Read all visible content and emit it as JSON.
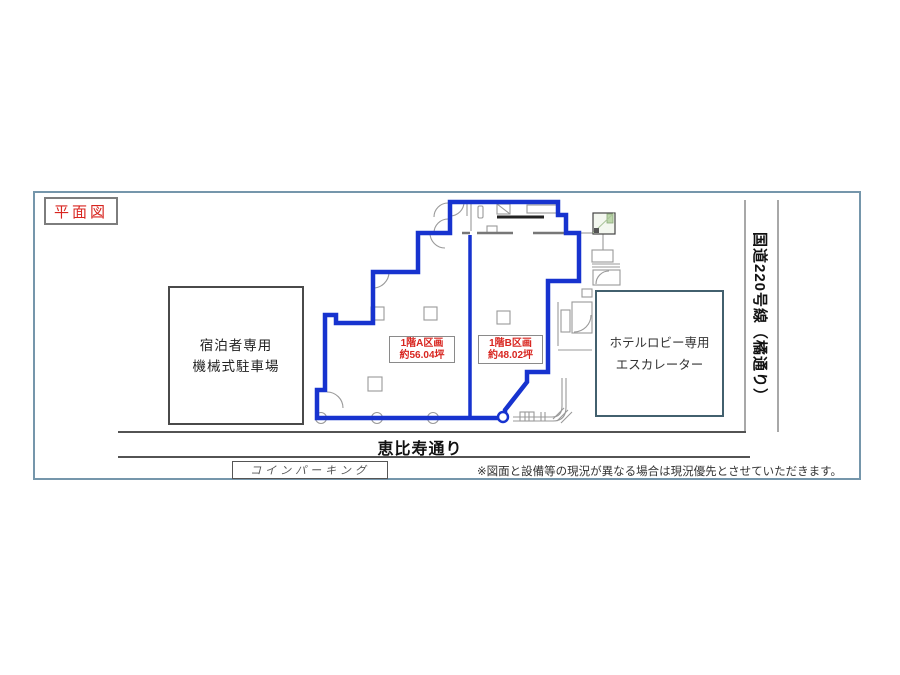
{
  "title_box": "平面図",
  "plan": {
    "section_a": {
      "line1": "1階A区画",
      "line2": "約56.04坪"
    },
    "section_b": {
      "line1": "1階B区画",
      "line2": "約48.02坪"
    },
    "parking_box": {
      "line1": "宿泊者専用",
      "line2": "機械式駐車場"
    },
    "hotel_box": {
      "line1": "ホテルロビー専用",
      "line2": "エスカレーター"
    }
  },
  "roads": {
    "bottom": "恵比寿通り",
    "right": "国道220号線（橘通り）",
    "coin_parking": "コインパーキング"
  },
  "disclaimer": "※図面と設備等の現況が異なる場合は現況優先とさせていただきます。",
  "colors": {
    "outline_blue": "#1733cf",
    "label_red": "#d8251f",
    "frame_slate": "#7596ab",
    "wall_gray": "#999999"
  }
}
